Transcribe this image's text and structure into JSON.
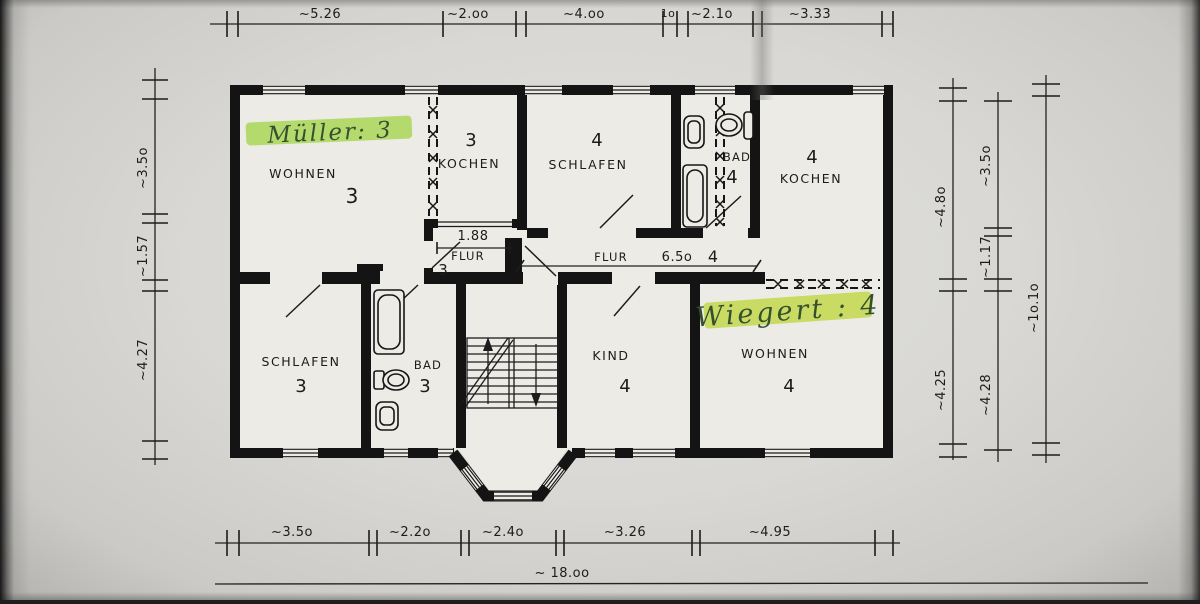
{
  "rooms": {
    "wohnen3": {
      "name": "WOHNEN",
      "no": "3"
    },
    "kochen3": {
      "name": "KOCHEN",
      "no": "3"
    },
    "schlafen4": {
      "name": "SCHLAFEN",
      "no": "4"
    },
    "bad4": {
      "name": "BAD",
      "no": "4"
    },
    "kochen4": {
      "name": "KOCHEN",
      "no": "4"
    },
    "flur3": {
      "name": "FLUR",
      "no": "3"
    },
    "flur4": {
      "name": "FLUR",
      "no": "4"
    },
    "schlafen3": {
      "name": "SCHLAFEN",
      "no": "3"
    },
    "bad3": {
      "name": "BAD",
      "no": "3"
    },
    "kind4": {
      "name": "KIND",
      "no": "4"
    },
    "wohnen4": {
      "name": "WOHNEN",
      "no": "4"
    }
  },
  "annotations": {
    "tenant_top": "Müller: 3",
    "tenant_bottom": "Wiegert : 4"
  },
  "dims": {
    "top": {
      "d1": "~5.26",
      "d2": "~2.oo",
      "d3": "~4.oo",
      "d4": "1o",
      "d5": "~2.1o",
      "d6": "~3.33"
    },
    "left": {
      "d1": "~3.5o",
      "d2": "~1.57",
      "d3": "~4.27"
    },
    "right1": {
      "d1": "~4.8o",
      "d2": "~4.25"
    },
    "right2": {
      "d1": "~3.5o",
      "d2": "~1.17",
      "d3": "~4.28"
    },
    "right3": {
      "d1": "~1o.1o"
    },
    "bottom": {
      "d1": "~3.5o",
      "d2": "~2.2o",
      "d3": "~2.4o",
      "d4": "~3.26",
      "d5": "~4.95"
    },
    "total": "~ 18.oo",
    "flur": "6.5o",
    "door": "1.88"
  },
  "colors": {
    "wall": "#141414",
    "paper": "#d9d8d4",
    "room_fill": "#ecebe6",
    "highlight_green": "#a6d54d",
    "highlight_yellow": "#c3d84a",
    "ink": "#1c1c1c",
    "handwriting_ink": "#35502e"
  }
}
